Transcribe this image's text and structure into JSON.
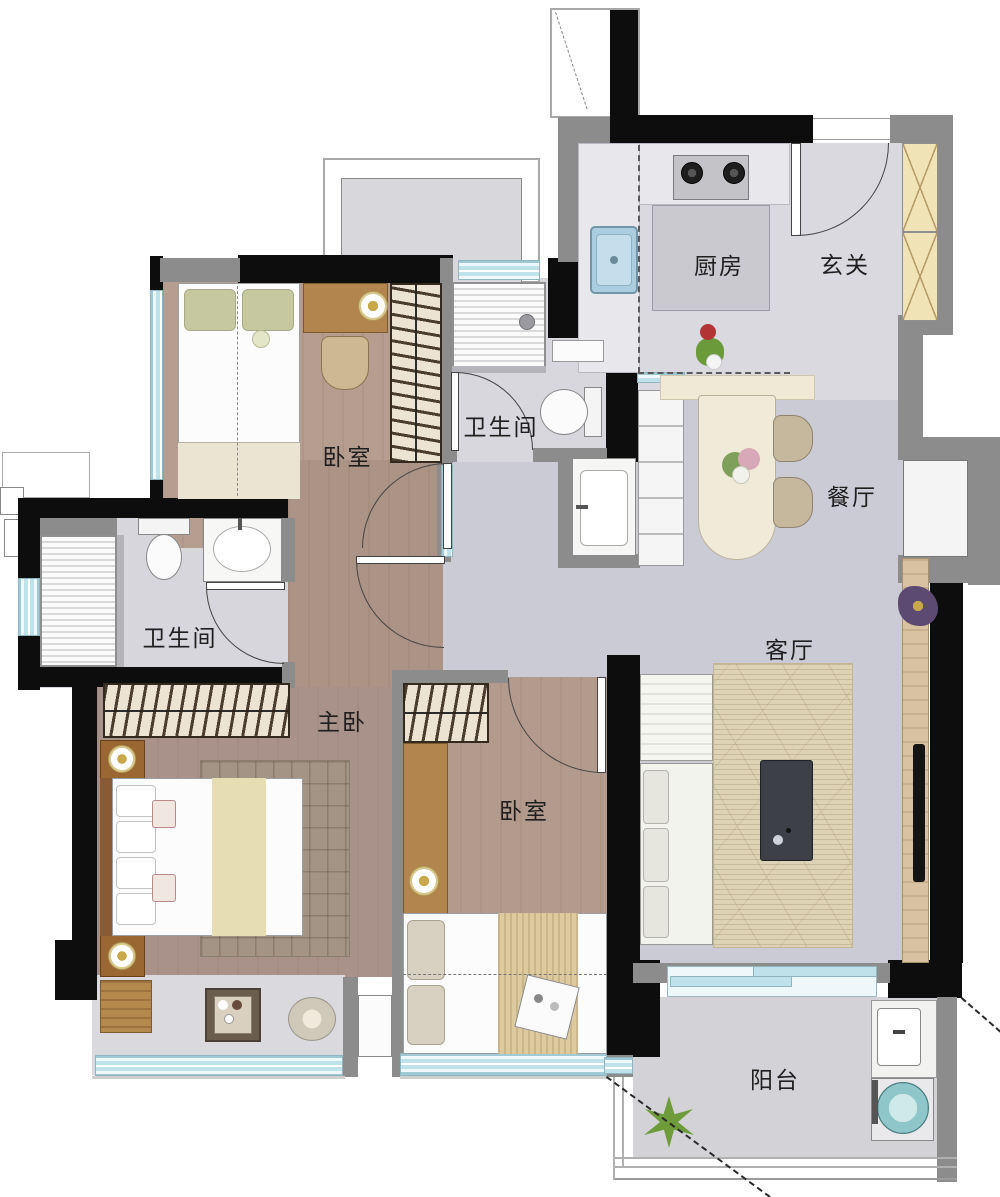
{
  "floorplan": {
    "type": "apartment-floor-plan",
    "rooms": [
      {
        "id": "kitchen",
        "label": "厨房"
      },
      {
        "id": "entry",
        "label": "玄关"
      },
      {
        "id": "bathroom-upper",
        "label": "卫生间"
      },
      {
        "id": "bedroom-upper",
        "label": "卧室"
      },
      {
        "id": "bathroom-left",
        "label": "卫生间"
      },
      {
        "id": "dining",
        "label": "餐厅"
      },
      {
        "id": "living",
        "label": "客厅"
      },
      {
        "id": "master-bedroom",
        "label": "主卧"
      },
      {
        "id": "bedroom-lower",
        "label": "卧室"
      },
      {
        "id": "balcony",
        "label": "阳台"
      }
    ],
    "furniture": {
      "kitchen": [
        "gas-stove",
        "kitchen-sink",
        "island-counter",
        "vegetable-decor"
      ],
      "entry": [
        "entry-door",
        "shoe-cabinet"
      ],
      "bathroom-upper": [
        "shower",
        "toilet",
        "shelf"
      ],
      "hallway": [
        "vanity-sink",
        "sideboard-cabinet"
      ],
      "bedroom-upper": [
        "single-bed",
        "desk",
        "table-lamp",
        "chair",
        "wardrobe"
      ],
      "bathroom-left": [
        "shower",
        "toilet",
        "vanity-sink"
      ],
      "dining": [
        "dining-table",
        "flower-centerpiece",
        "dining-chairs"
      ],
      "living": [
        "sofa",
        "rug",
        "coffee-table",
        "tv",
        "tv-wood-panel",
        "plant"
      ],
      "master-bedroom": [
        "wardrobe",
        "double-bed",
        "nightstands",
        "rug",
        "bench",
        "side-table",
        "pouf"
      ],
      "bedroom-lower": [
        "wardrobe",
        "desk",
        "table-lamp",
        "bed"
      ],
      "balcony": [
        "plant",
        "laundry-sink",
        "washing-machine"
      ]
    },
    "colors": {
      "structural_wall": "#0d0d0d",
      "partition_wall": "#8c8c8c",
      "window_glass": "#bfe2ea",
      "hall_tile": "#cbcbd5",
      "kitchen_tile": "#d9d9df",
      "wood_floor": "#ad9689",
      "balcony_tile": "#d2d2d7",
      "wardrobe_front": "#ece3d2",
      "shoe_cabinet": "#f0e3b6",
      "dining_table": "#f0ead8",
      "wood_furniture": "#b2854f",
      "tv_panel_wood": "#d9c2a2",
      "coffee_table": "#3d4147",
      "washer_drum": "#8ec6ca",
      "plant_green": "#6f9c3a"
    }
  }
}
